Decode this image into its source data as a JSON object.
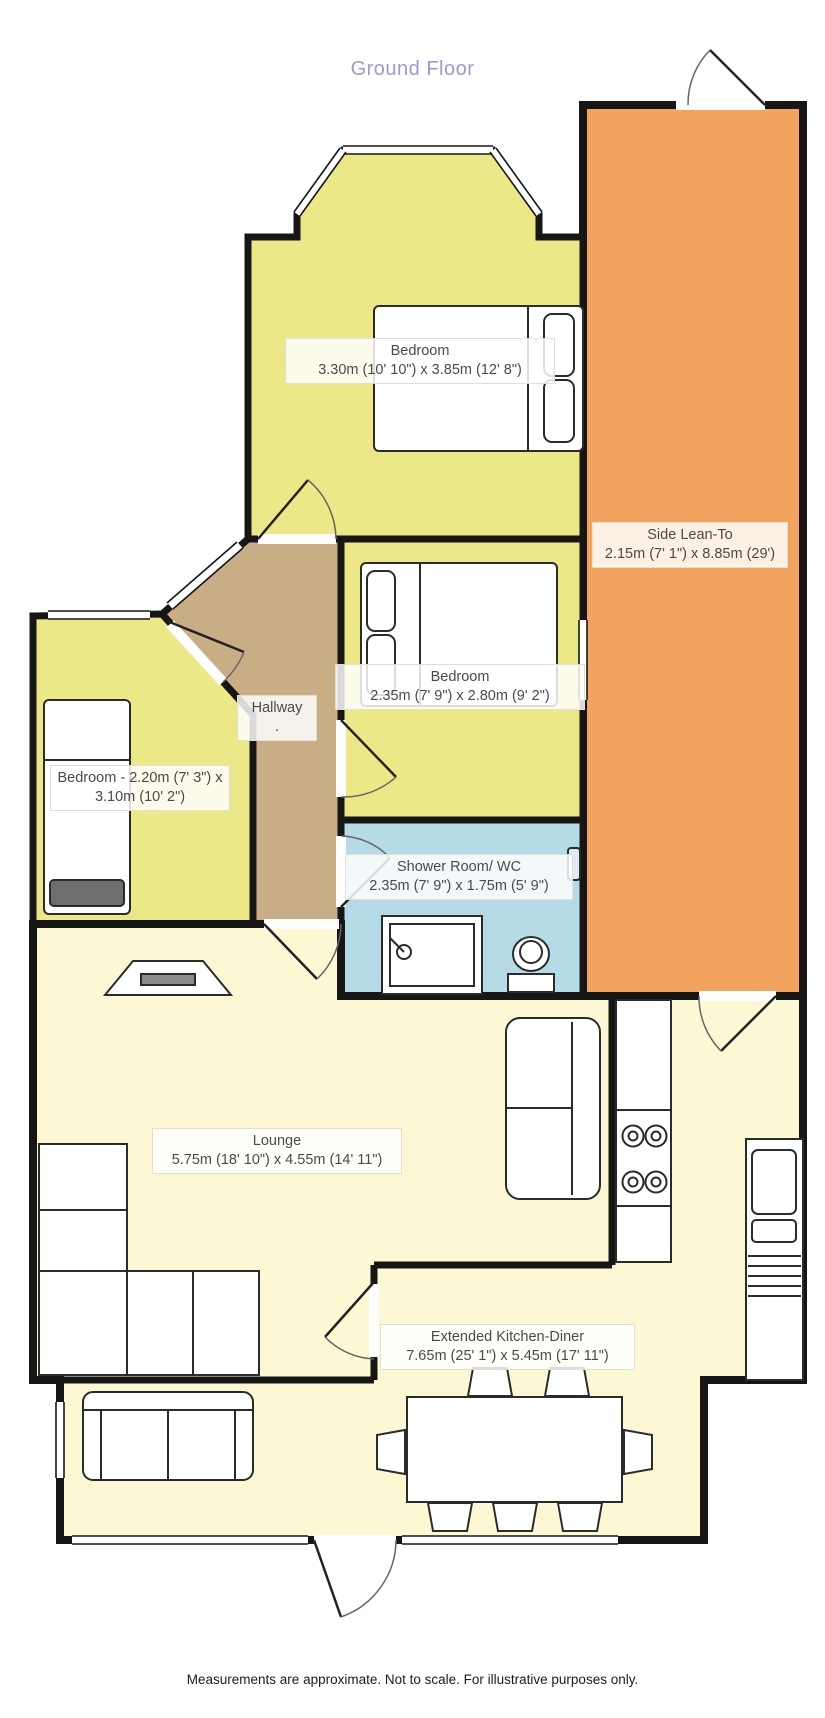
{
  "title": "Ground Floor",
  "footer": "Measurements are approximate. Not to scale. For illustrative purposes only.",
  "rooms": {
    "bedroom_top": {
      "name": "Bedroom",
      "dims": "3.30m (10' 10\") x 3.85m (12' 8\")"
    },
    "side_lean_to": {
      "name": "Side Lean-To",
      "dims": "2.15m (7' 1\") x 8.85m (29')"
    },
    "bedroom_middle": {
      "name": "Bedroom",
      "dims": "2.35m (7' 9\") x 2.80m (9' 2\")"
    },
    "hallway": {
      "name": "Hallway",
      "dims": "."
    },
    "bedroom_left": {
      "name": "Bedroom - 2.20m (7' 3\") x 3.10m (10' 2\")"
    },
    "shower_room": {
      "name": "Shower Room/ WC",
      "dims": "2.35m (7' 9\") x 1.75m (5' 9\")"
    },
    "lounge": {
      "name": "Lounge",
      "dims": "5.75m (18' 10\") x 4.55m (14' 11\")"
    },
    "kitchen_diner": {
      "name": "Extended Kitchen-Diner",
      "dims": "7.65m (25' 1\") x 5.45m (17' 11\")"
    }
  },
  "colors": {
    "bedroom_fill": "#ECE787",
    "lean_to_fill": "#F2A45F",
    "hallway_fill": "#C9AD85",
    "shower_fill": "#B5DBE6",
    "living_fill": "#FDF8D4",
    "wall": "#161616",
    "title_text": "#9A9AD6",
    "label_text": "#4A4A4A"
  }
}
